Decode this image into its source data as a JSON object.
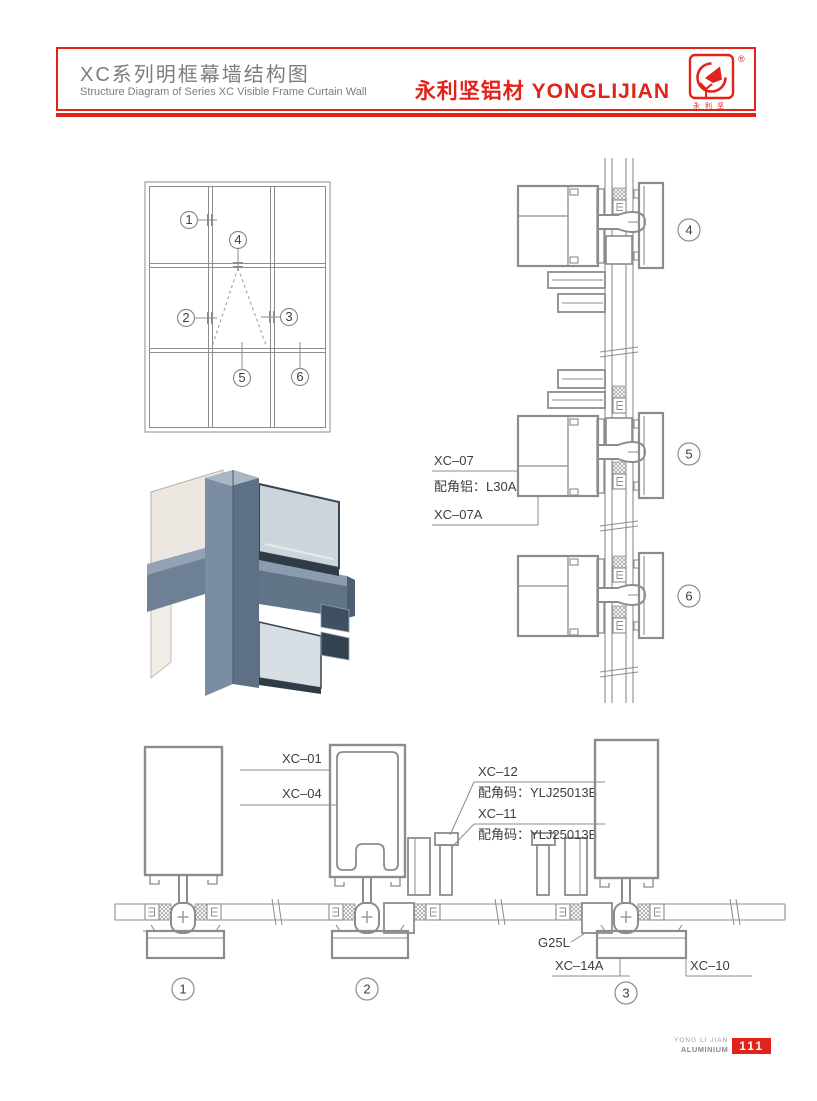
{
  "header": {
    "title_zh": "XC系列明框幕墙结构图",
    "title_en": "Structure Diagram of Series XC Visible Frame Curtain Wall",
    "brand": "永利坚铝材 YONGLIJIAN",
    "logo_registered": "®",
    "logo_caption": "永利坚"
  },
  "colors": {
    "accent_red": "#e2231a",
    "line_gray": "#8c8c8c",
    "header_text_gray": "#7d7d7d",
    "label_dark": "#3e3e3e"
  },
  "elevation": {
    "callouts": [
      "1",
      "2",
      "3",
      "4",
      "5",
      "6"
    ]
  },
  "vertical_sections": {
    "callouts": [
      "4",
      "5",
      "6"
    ],
    "labels": [
      "XC–07",
      "配角铝：L30A",
      "XC–07A"
    ]
  },
  "horizontal_sections": {
    "callouts": [
      "1",
      "2",
      "3"
    ],
    "labels": [
      "XC–01",
      "XC–04",
      "XC–12",
      "配角码：YLJ25013B",
      "XC–11",
      "配角码：YLJ25013B",
      "G25L",
      "XC–14A",
      "XC–10"
    ]
  },
  "footer": {
    "brand_line1": "YONG LI JIAN",
    "brand_line2": "ALUMINIUM",
    "page_number": "111"
  }
}
